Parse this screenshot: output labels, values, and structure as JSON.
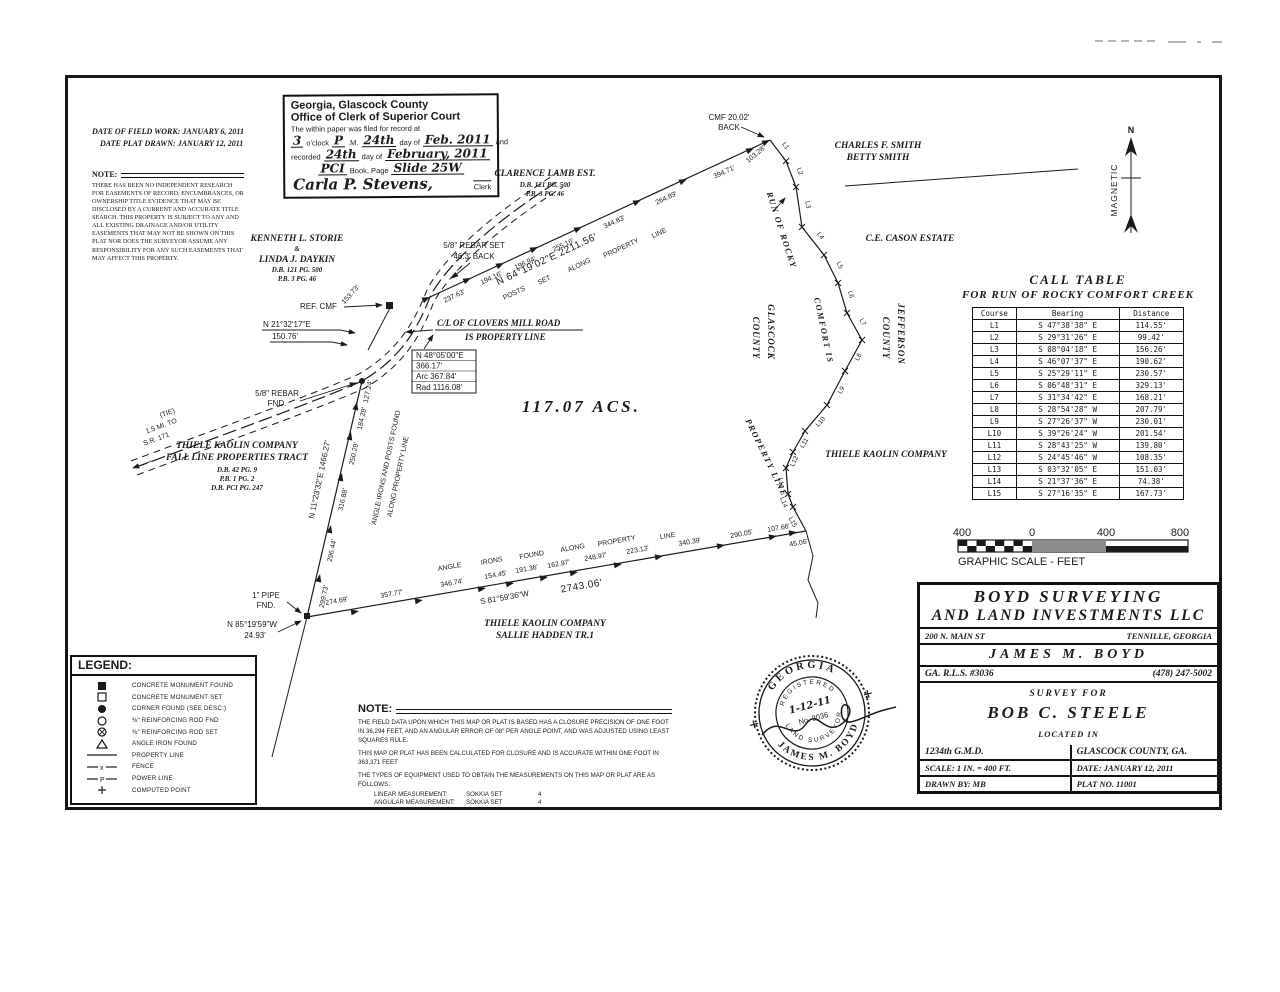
{
  "document": {
    "clerk_stamp": {
      "line1": "Georgia, Glascock County",
      "line2": "Office of Clerk of Superior Court",
      "line3": "The within paper was filed for record at",
      "filed": {
        "hour": "3",
        "oclock": "o'clock",
        "ampm": "P",
        "m": ".M.",
        "day": "24th",
        "day_of": "day of",
        "month": "Feb. 2011",
        "and": "and"
      },
      "recorded": {
        "recorded": "recorded",
        "day": "24th",
        "day_of": "day of",
        "month": "February, 2011"
      },
      "book": {
        "book_val": "PCI",
        "book_label": "Book, Page",
        "page_val": "Slide 25W"
      },
      "signature": "Carla P. Stevens,",
      "clerk": "Clerk"
    },
    "dates": {
      "field_work": "DATE OF FIELD WORK: JANUARY 6, 2011",
      "plat_drawn": "DATE PLAT DRAWN: JANUARY 12, 2011"
    },
    "easement_note": {
      "heading": "NOTE:",
      "body": "THERE HAS BEEN NO INDEPENDENT RESEARCH FOR EASEMENTS OF RECORD, ENCUMBRANCES, OR OWNERSHIP TITLE EVIDENCE THAT MAY BE DISCLOSED BY A CURRENT AND ACCURATE TITLE SEARCH. THIS PROPERTY IS SUBJECT TO ANY AND ALL EXISTING DRAINAGE AND/OR UTILITY EASEMENTS THAT MAY NOT BE SHOWN ON THIS PLAT NOR DOES THE SURVEYOR ASSUME ANY RESPONSIBILITY FOR ANY SUCH EASEMENTS THAT MAY AFFECT THIS PROPERTY."
    }
  },
  "plat": {
    "acreage": "117.07  ACS.",
    "north_arrow": {
      "n": "N",
      "label": "MAGNETIC"
    },
    "storie": {
      "l1": "KENNETH L. STORIE",
      "l2": "&",
      "l3": "LINDA J. DAYKIN",
      "l4": "D.B. 121 PG. 500",
      "l5": "P.B. 3 PG. 46"
    },
    "lamb": {
      "l1": "CLARENCE LAMB EST.",
      "l2": "D.B. 121 PG. 500",
      "l3": "P.B. 3 PG. 46"
    },
    "smith": {
      "l1": "CHARLES F. SMITH",
      "l2": "BETTY SMITH"
    },
    "cason": "C.E. CASON ESTATE",
    "thiele_east": "THIELE KAOLIN COMPANY",
    "thiele_west": {
      "l1": "THIELE KAOLIN COMPANY",
      "l2": "FALL LINE PROPERTIES TRACT",
      "l3": "D.B. 42 PG. 9",
      "l4": "P.B. 1 PG. 2",
      "l5": "D.B. PCI PG. 247"
    },
    "thiele_south": {
      "l1": "THIELE KAOLIN COMPANY",
      "l2": "SALLIE HADDEN TR.1"
    },
    "county_west": {
      "l1": "GLASCOCK",
      "l2": "COUNTY"
    },
    "county_east": {
      "l1": "JEFFERSON",
      "l2": "COUNTY"
    },
    "creek_label": {
      "p1": "RUN OF ROCKY",
      "p2": "COMFORT IS",
      "p3": "PROPERTY LINE"
    },
    "north_line": {
      "bearing": "N 64°19'02\"E  2211.56'",
      "note": {
        "w1": "POSTS",
        "w2": "SET",
        "w3": "ALONG",
        "w4": "PROPERTY",
        "w5": "LINE"
      },
      "segments": [
        "237.63'",
        "194.16'",
        "196.94'",
        "255.16'",
        "344.83'",
        "264.89'",
        "394.71'",
        "103.28'"
      ]
    },
    "west_line": {
      "bearing": "N 11°23'32\"E  1466.27'",
      "note1": "ANGLE IRONS AND POSTS FOUND",
      "note2": "ALONG PROPERTY LINE",
      "segments": [
        "127.24'",
        "184.29'",
        "250.29'",
        "316.88'",
        "296.44'",
        "299.73'"
      ]
    },
    "south_line": {
      "bearing": "S 81°59'36\"W",
      "total": "2743.06'",
      "note": {
        "w1": "ANGLE",
        "w2": "IRONS",
        "w3": "FOUND",
        "w4": "ALONG",
        "w5": "PROPERTY",
        "w6": "LINE"
      },
      "segments": [
        "274.69'",
        "357.77'",
        "346.74'",
        "154.45'",
        "191.36'",
        "162.97'",
        "248.97'",
        "223.13'",
        "340.39'",
        "290.05'",
        "107.66'",
        "45.06'"
      ]
    },
    "road": {
      "name1": "C/L OF CLOVERS MILL ROAD",
      "name2": "IS PROPERTY LINE",
      "curve": {
        "l1": "N 48°05'00\"E",
        "l2": "366.17'",
        "l3": "Arc 367.84'",
        "l4": "Rad 1116.08'"
      },
      "tie": {
        "l1": "(TIE)",
        "l2": "1.5 MI. TO",
        "l3": "S.R. 171"
      },
      "segment": "153.73'"
    },
    "monuments": {
      "ref_cmf": "REF. CMF",
      "cmf_tie1": "N 21°32'17\"E",
      "cmf_tie2": "150.76'",
      "rebar_fnd1": "5/8\" REBAR",
      "rebar_fnd2": "FND.",
      "rebar_set1": "5/8\" REBAR SET",
      "rebar_set2": "46.3' BACK",
      "cmf_back1": "CMF 20.02'",
      "cmf_back2": "BACK",
      "pipe1": "1\" PIPE",
      "pipe2": "FND.",
      "pipe_tie1": "N 85°19'59\"W",
      "pipe_tie2": "24.93'"
    },
    "course_labels": [
      "L1",
      "L2",
      "L3",
      "L4",
      "L5",
      "L6",
      "L7",
      "L8",
      "L9",
      "L10",
      "L11",
      "L12",
      "L13",
      "L14",
      "L15"
    ]
  },
  "call_table": {
    "title1": "CALL TABLE",
    "title2": "FOR RUN OF ROCKY COMFORT CREEK",
    "headers": [
      "Course",
      "Bearing",
      "Distance"
    ],
    "rows": [
      [
        "L1",
        "S 47°38'38\" E",
        "114.55'"
      ],
      [
        "L2",
        "S 29°31'26\" E",
        "99.42'"
      ],
      [
        "L3",
        "S 08°04'18\" E",
        "156.26'"
      ],
      [
        "L4",
        "S 46°07'37\" E",
        "190.62'"
      ],
      [
        "L5",
        "S 25°29'11\" E",
        "230.57'"
      ],
      [
        "L6",
        "S 06°48'31\" E",
        "329.13'"
      ],
      [
        "L7",
        "S 31°34'42\" E",
        "168.21'"
      ],
      [
        "L8",
        "S 28°54'28\" W",
        "207.79'"
      ],
      [
        "L9",
        "S 27°26'37\" W",
        "230.01'"
      ],
      [
        "L10",
        "S 39°26'24\" W",
        "201.54'"
      ],
      [
        "L11",
        "S 28°43'25\" W",
        "139.80'"
      ],
      [
        "L12",
        "S 24°45'46\" W",
        "108.35'"
      ],
      [
        "L13",
        "S 03°32'05\" E",
        "151.03'"
      ],
      [
        "L14",
        "S 21°37'36\" E",
        "74.38'"
      ],
      [
        "L15",
        "S 27°16'35\" E",
        "167.73'"
      ]
    ]
  },
  "scale_bar": {
    "t1": "400",
    "t2": "0",
    "t3": "400",
    "t4": "800",
    "label": "GRAPHIC SCALE - FEET"
  },
  "legend": {
    "title": "LEGEND:",
    "fence_glyph": "x",
    "power_glyph": "P",
    "items": [
      {
        "symbol": "concrete-monument-found",
        "label": "CONCRETE MONUMENT FOUND"
      },
      {
        "symbol": "concrete-monument-set",
        "label": "CONCRETE MONUMENT SET"
      },
      {
        "symbol": "corner-found",
        "label": "CORNER FOUND (SEE DESC.)"
      },
      {
        "symbol": "reinforcing-rod-found",
        "label": "⅜\" REINFORCING ROD FND"
      },
      {
        "symbol": "reinforcing-rod-set",
        "label": "⅜\" REINFORCING ROD SET"
      },
      {
        "symbol": "angle-iron-found",
        "label": "ANGLE IRON FOUND"
      },
      {
        "symbol": "property-line",
        "label": "PROPERTY LINE"
      },
      {
        "symbol": "fence",
        "label": "FENCE"
      },
      {
        "symbol": "power-line",
        "label": "POWER LINE"
      },
      {
        "symbol": "computed-point",
        "label": "COMPUTED POINT"
      }
    ]
  },
  "survey_note": {
    "heading": "NOTE:",
    "p1": "THE FIELD DATA UPON WHICH THIS MAP OR PLAT IS BASED HAS A CLOSURE PRECISION OF ONE FOOT IN 36,294 FEET, AND AN ANGULAR ERROR OF 08\" PER ANGLE POINT, AND WAS ADJUSTED USING LEAST SQUARES RULE.",
    "p2": "THIS MAP OR PLAT HAS BEEN CALCULATED FOR CLOSURE AND IS ACCURATE WITHIN ONE FOOT IN 363,371 FEET",
    "p3": "THE TYPES OF EQUIPMENT USED TO OBTAIN THE MEASUREMENTS ON THIS MAP OR PLAT ARE AS FOLLOWS:",
    "equip1_label": "LINEAR MEASUREMENT:",
    "equip1_val": "SOKKIA SET",
    "equip1_num": "4",
    "equip2_label": "ANGULAR MEASUREMENT:",
    "equip2_val": "SOKKIA SET",
    "equip2_num": "4"
  },
  "title_block": {
    "company1": "BOYD  SURVEYING",
    "company2": "AND  LAND  INVESTMENTS  LLC",
    "address": "200 N. MAIN ST",
    "city": "TENNILLE, GEORGIA",
    "surveyor": "JAMES  M.  BOYD",
    "license": "GA. R.L.S. #3036",
    "phone": "(478) 247-5002",
    "survey_for": "SURVEY FOR",
    "client": "BOB  C.  STEELE",
    "located_in": "LOCATED IN",
    "gmd": "1234th G.M.D.",
    "county": "GLASCOCK COUNTY, GA.",
    "scale": "SCALE: 1 IN. = 400 FT.",
    "date": "DATE: JANUARY 12, 2011",
    "drawn_by": "DRAWN BY: MB",
    "plat_no": "PLAT NO. 11001"
  },
  "seal": {
    "state": "GEORGIA",
    "registered": "REGISTERED",
    "date": "1-12-11",
    "number": "No. 3036",
    "profession": "LAND SURVEYOR",
    "name": "JAMES M. BOYD"
  }
}
